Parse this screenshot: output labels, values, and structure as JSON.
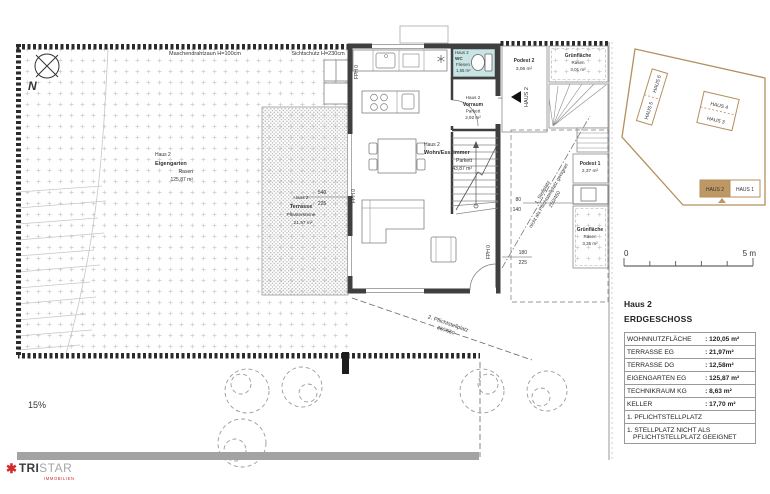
{
  "plan": {
    "north_label": "N",
    "fence_label_left": "Maschendrahtzaun H=100cm",
    "fence_label_right": "Sichtschutz H=230cm",
    "slope_label": "15%",
    "rooms": {
      "eigengarten": {
        "haus": "Haus 2",
        "name": "Eigengarten",
        "finish": "Rasen",
        "area": "125,87 m²"
      },
      "terrasse": {
        "haus": "Haus 2",
        "name": "Terrasse",
        "finish": "Pflastersteine",
        "area": "21,97 m²"
      },
      "wohnen": {
        "haus": "Haus 2",
        "name": "Wohn/Esszimmer",
        "finish": "Parkett",
        "area": "43,87 m²"
      },
      "wc": {
        "haus": "Haus 2",
        "name": "WC",
        "finish": "Fliesen",
        "area": "1,65 m²"
      },
      "vorraum": {
        "haus": "Haus 2",
        "name": "Vorraum",
        "finish": "Parkett",
        "area": "2,92 m²"
      },
      "podest2": {
        "name": "Podest 2",
        "area": "3,06 m²"
      },
      "gruen_top": {
        "name": "Grünfläche",
        "finish": "Rasen",
        "area": "3,01 m²"
      },
      "podest1": {
        "name": "Podest 1",
        "area": "2,37 m²"
      },
      "gruen_bottom": {
        "name": "Grünfläche",
        "finish": "Rasen",
        "area": "3,35 m²"
      }
    },
    "entry_label": "HAUS 2",
    "parking1": {
      "line1": "1. Stellplatz",
      "line2": "nicht als Pflichtstellplatz geeignet",
      "dim": "250/450"
    },
    "parking2": {
      "line1": "2. Pflichtstellplatz",
      "dim": "250/550"
    },
    "dims": {
      "terrace_w": "540",
      "terrace_d": "225",
      "d80": "80",
      "d140": "140",
      "d180": "180",
      "d225": "225"
    },
    "fph_label": "FPH 0"
  },
  "minimap": {
    "houses": [
      "HAUS 1",
      "HAUS 2",
      "HAUS 3",
      "HAUS 4",
      "HAUS 5",
      "HAUS 6"
    ],
    "accent": "#b3905f"
  },
  "scalebar": {
    "start": "0",
    "end": "5 m"
  },
  "info": {
    "title": "Haus 2",
    "subtitle": "ERDGESCHOSS",
    "rows": [
      {
        "label": "WOHNNUTZFLÄCHE",
        "value": ": 120,05 m²"
      },
      {
        "label": "TERRASSE  EG",
        "value": ": 21,97m²"
      },
      {
        "label": "TERRASSE  DG",
        "value": ": 12,58m²"
      },
      {
        "label": "EIGENGARTEN  EG",
        "value": ": 125,87 m²"
      },
      {
        "label": "TECHNIKRAUM  KG",
        "value": ": 8,63 m²"
      },
      {
        "label": "KELLER",
        "value": ": 17,70 m²"
      }
    ],
    "notes": [
      "1. PFLICHTSTELLPLATZ",
      "1. STELLPLATZ NICHT ALS",
      "PFLICHTSTELLPLATZ GEEIGNET"
    ]
  },
  "logo": {
    "part1": "TRI",
    "part2": "STAR",
    "subtitle": "IMMOBILIEN"
  }
}
